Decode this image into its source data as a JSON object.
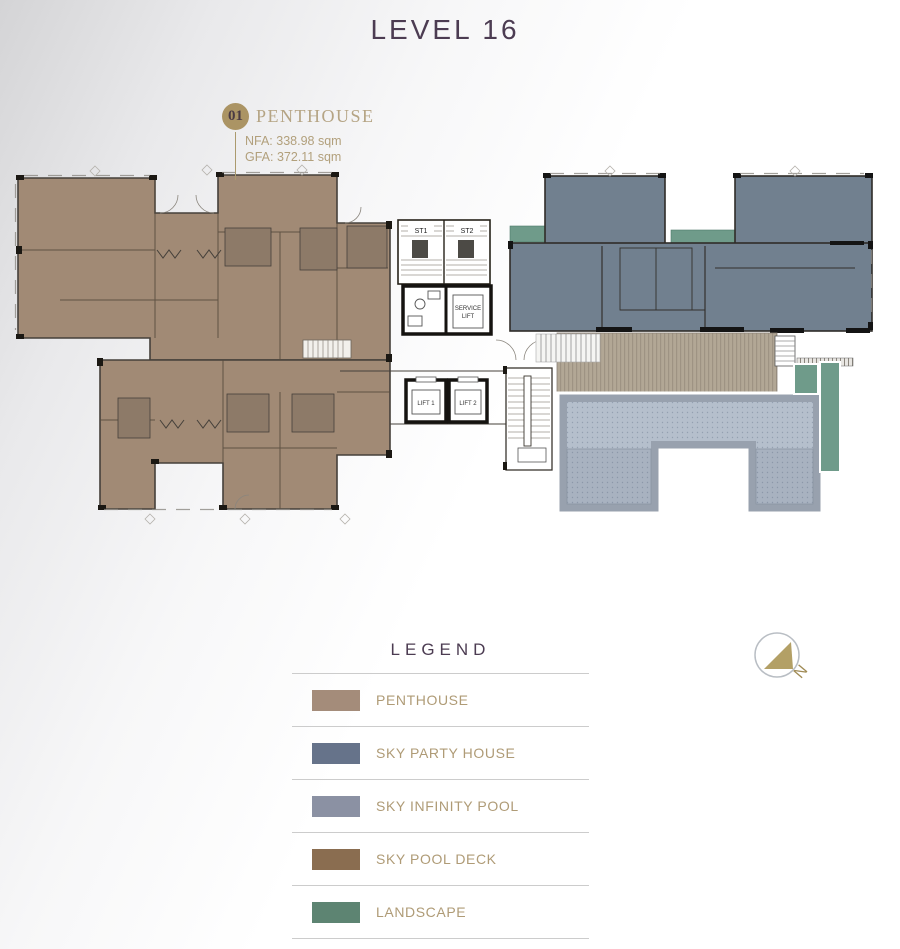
{
  "page": {
    "title": "LEVEL 16"
  },
  "unit": {
    "number": "01",
    "name": "PENTHOUSE",
    "nfa": "NFA: 338.98 sqm",
    "gfa": "GFA: 372.11 sqm"
  },
  "plan": {
    "st1": "ST1",
    "st2": "ST2",
    "service_lift_line1": "SERVICE",
    "service_lift_line2": "LIFT",
    "lift1": "LIFT 1",
    "lift2": "LIFT 2"
  },
  "compass": {
    "north": "N"
  },
  "legend": {
    "title": "LEGEND",
    "items": [
      {
        "label": "PENTHOUSE",
        "color": "#a48c7a"
      },
      {
        "label": "SKY PARTY HOUSE",
        "color": "#66738a"
      },
      {
        "label": "SKY INFINITY POOL",
        "color": "#8b91a3"
      },
      {
        "label": "SKY POOL DECK",
        "color": "#8a6d50"
      },
      {
        "label": "LANDSCAPE",
        "color": "#5d8472"
      }
    ]
  },
  "colors": {
    "penthouse_fill": "#a18a75",
    "penthouse_dark": "#8d7a68",
    "party_house_fill": "#71808f",
    "pool_edge": "#98a1ae",
    "landscape_fill": "#6f9b8a",
    "gold": "#b3a066",
    "gold_dark": "#a08b55"
  }
}
